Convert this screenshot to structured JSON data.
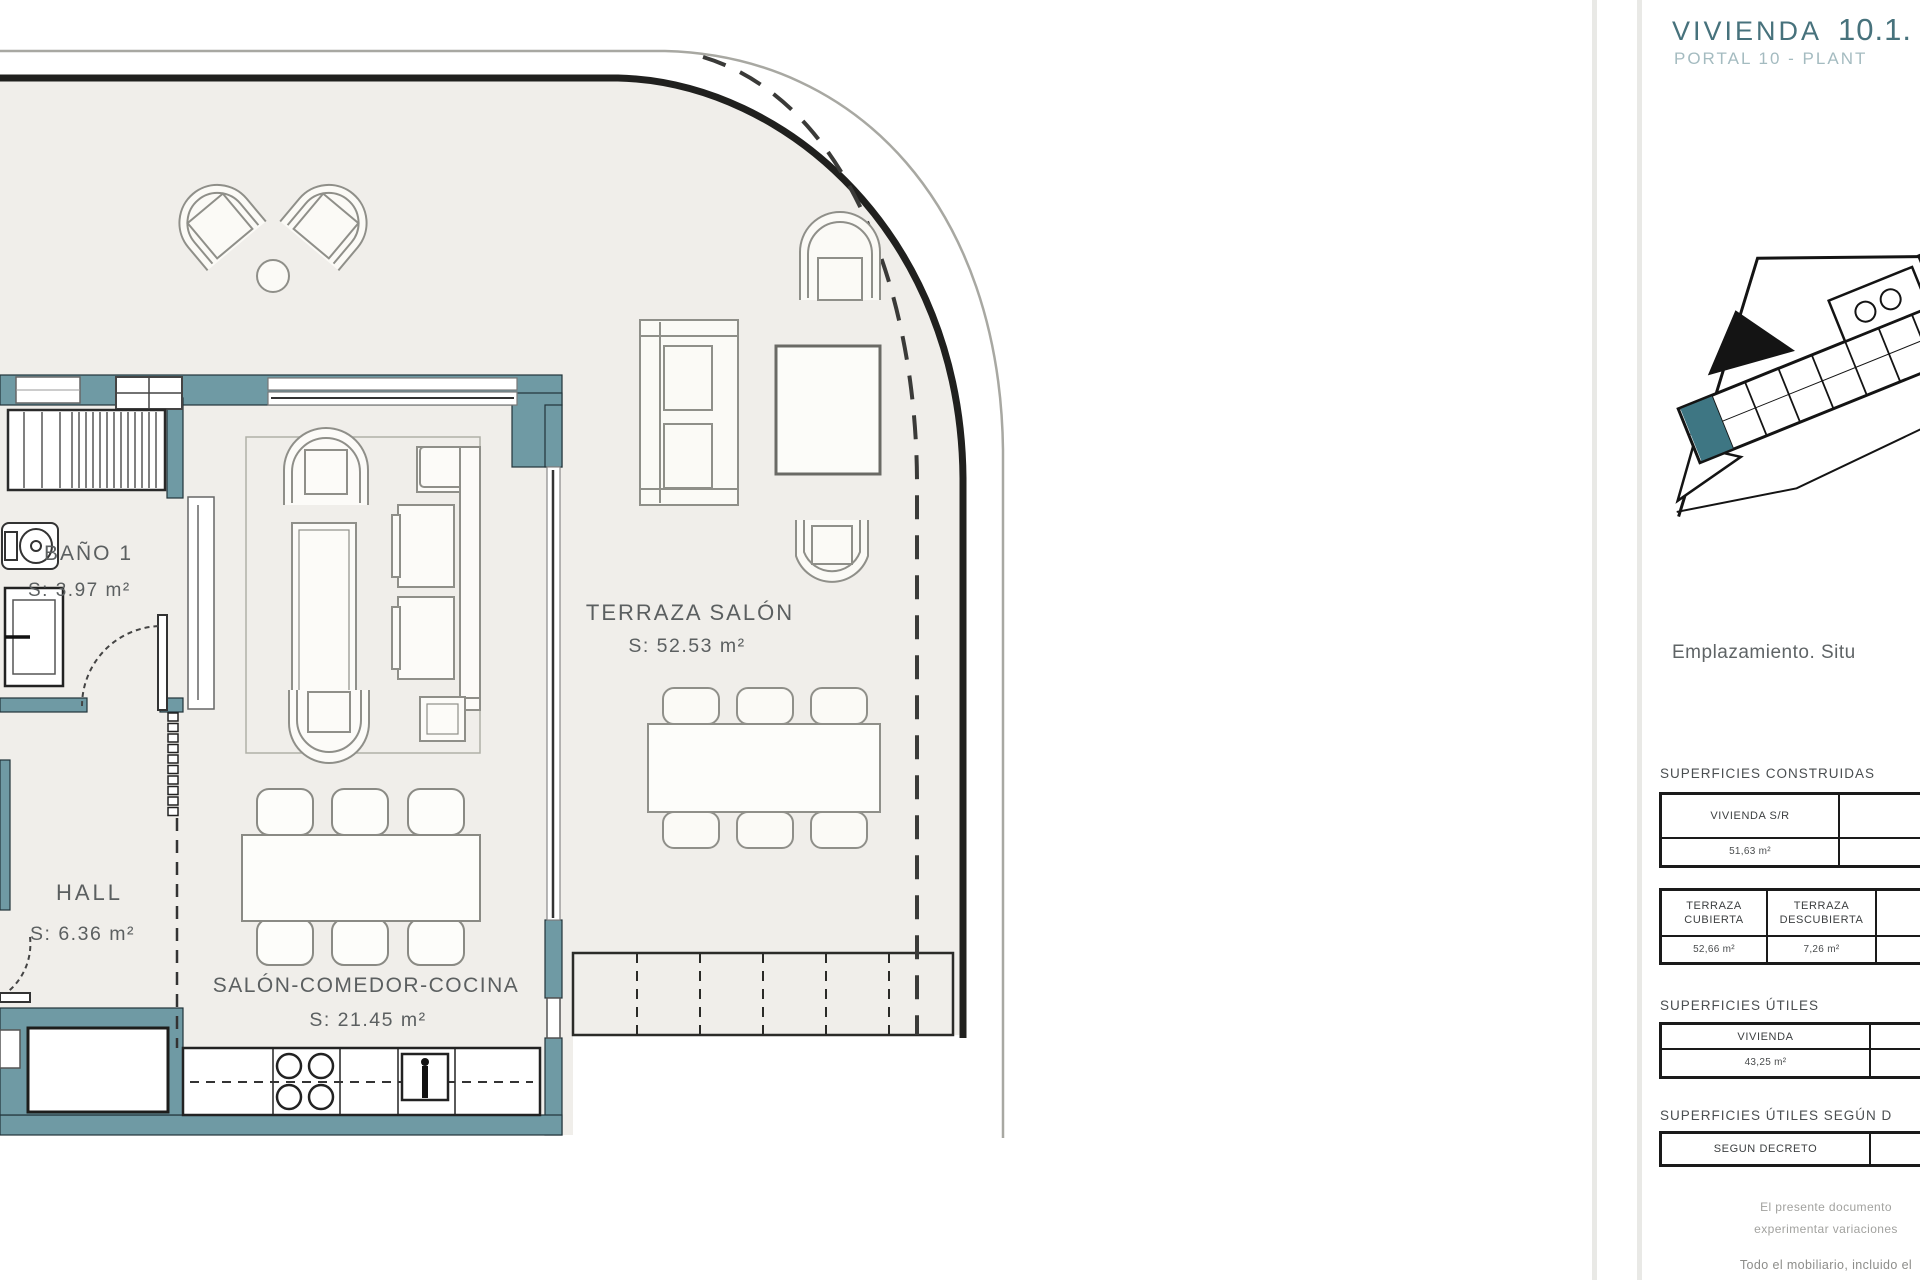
{
  "colors": {
    "wall_teal": "#6f9aa4",
    "floor_beige": "#f0eeea",
    "title_teal": "#47727c",
    "subtitle_teal": "#a4bbc0",
    "highlight_unit_teal": "#3e7683"
  },
  "plan": {
    "rooms": {
      "bano": {
        "name": "BAÑO 1",
        "area": "S: 3.97 m²"
      },
      "hall": {
        "name": "HALL",
        "area": "S: 6.36 m²"
      },
      "salon": {
        "name": "SALÓN-COMEDOR-COCINA",
        "area": "S: 21.45 m²"
      },
      "terraza": {
        "name": "TERRAZA SALÓN",
        "area": "S: 52.53 m²"
      }
    }
  },
  "panel": {
    "title": "VIVIENDA",
    "title_number": "10.1.",
    "subtitle": "PORTAL 10 - PLANT",
    "map_caption": "Emplazamiento. Situ",
    "constructed": {
      "label": "SUPERFICIES CONSTRUIDAS",
      "vivienda_sr": {
        "header": "VIVIENDA S/R",
        "value": "51,63 m²"
      },
      "terraza_cubierta": {
        "header_line1": "TERRAZA",
        "header_line2": "CUBIERTA",
        "value": "52,66 m²"
      },
      "terraza_descubierta": {
        "header_line1": "TERRAZA",
        "header_line2": "DESCUBIERTA",
        "value": "7,26 m²"
      }
    },
    "useful": {
      "label": "SUPERFICIES ÚTILES",
      "vivienda": {
        "header": "VIVIENDA",
        "value": "43,25 m²"
      }
    },
    "useful_decree": {
      "label": "SUPERFICIES ÚTILES SEGÚN D",
      "decreto": {
        "header": "SEGUN DECRETO"
      }
    },
    "disclaimer": {
      "line1": "El presente documento",
      "line2": "experimentar variaciones",
      "line3": "Todo el mobiliario, incluido el"
    }
  }
}
